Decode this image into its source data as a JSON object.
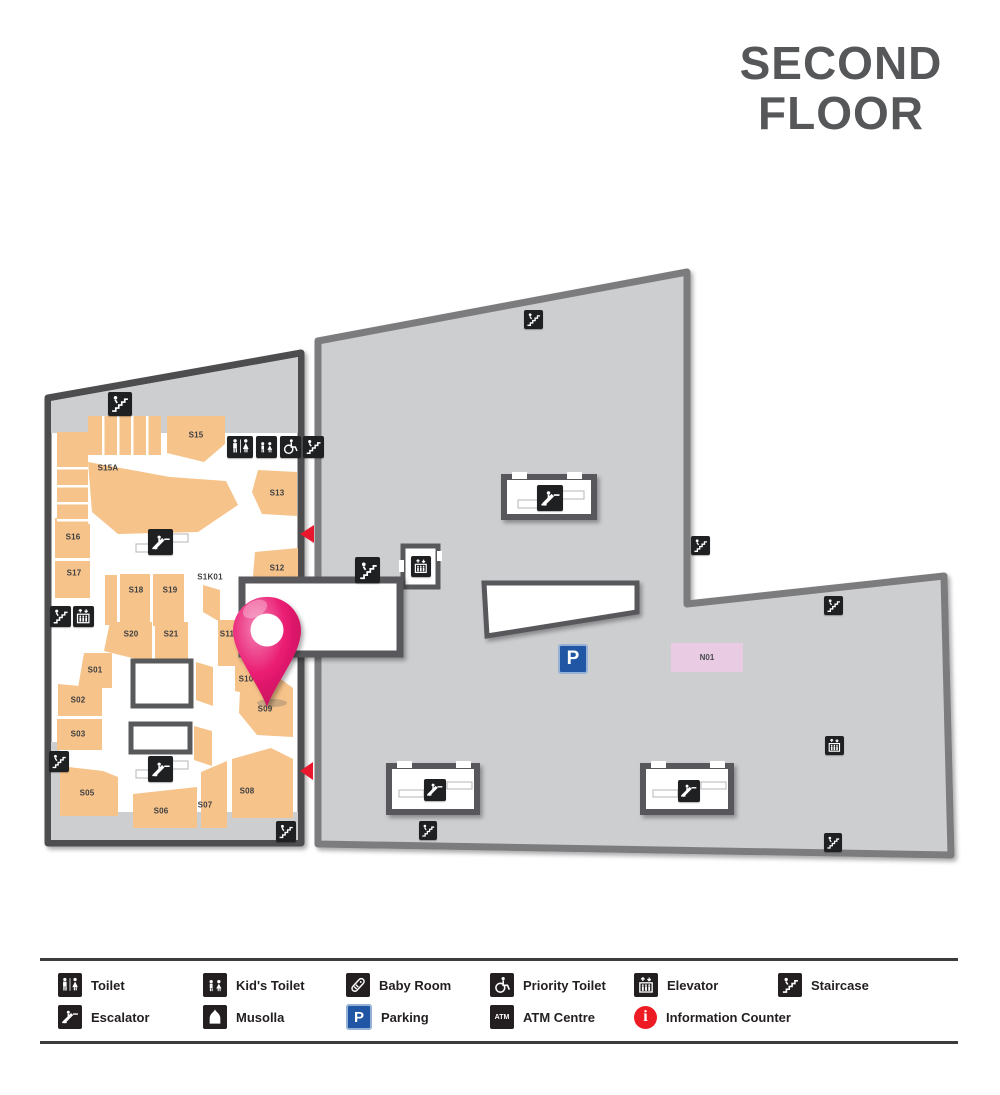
{
  "title": {
    "line1": "SECOND",
    "line2": "FLOOR"
  },
  "map": {
    "units": {
      "S15": "S15",
      "S15A": "S15A",
      "S13": "S13",
      "S16": "S16",
      "S17": "S17",
      "S18": "S18",
      "S19": "S19",
      "S1K01": "S1K01",
      "S12": "S12",
      "S20": "S20",
      "S21": "S21",
      "S11": "S11",
      "S10": "S10",
      "S09": "S09",
      "S01": "S01",
      "S02": "S02",
      "S03": "S03",
      "S05": "S05",
      "S06": "S06",
      "S07": "S07",
      "S08": "S08",
      "N01": "N01"
    }
  },
  "glyphs": {
    "parking": "P",
    "atm": "ATM",
    "info": "i"
  },
  "legend": {
    "items": [
      {
        "icon": "toilet-icon",
        "label": "Toilet"
      },
      {
        "icon": "kids-toilet-icon",
        "label": "Kid's Toilet"
      },
      {
        "icon": "baby-room-icon",
        "label": "Baby Room"
      },
      {
        "icon": "priority-toilet-icon",
        "label": "Priority Toilet"
      },
      {
        "icon": "elevator-icon",
        "label": "Elevator"
      },
      {
        "icon": "staircase-icon",
        "label": "Staircase"
      },
      {
        "icon": "escalator-icon",
        "label": "Escalator"
      },
      {
        "icon": "musolla-icon",
        "label": "Musolla"
      },
      {
        "icon": "parking-icon",
        "label": "Parking"
      },
      {
        "icon": "atm-icon",
        "label": "ATM Centre"
      },
      {
        "icon": "info-icon",
        "label": "Information Counter"
      }
    ]
  },
  "colors": {
    "shop_orange": "#f6c38a",
    "mall_gray": "#cdced0",
    "wall_dark": "#4d4e50",
    "wall_light": "#7b7c7f",
    "box_border": "#58595b",
    "icon_bg": "#1f2022",
    "arrow_red": "#e8172d",
    "pin_magenta": "#e91d74",
    "parking_blue": "#2056a3",
    "unit_n01_pink": "#e9cce4",
    "info_red": "#ed1c24",
    "title_gray": "#565759"
  }
}
